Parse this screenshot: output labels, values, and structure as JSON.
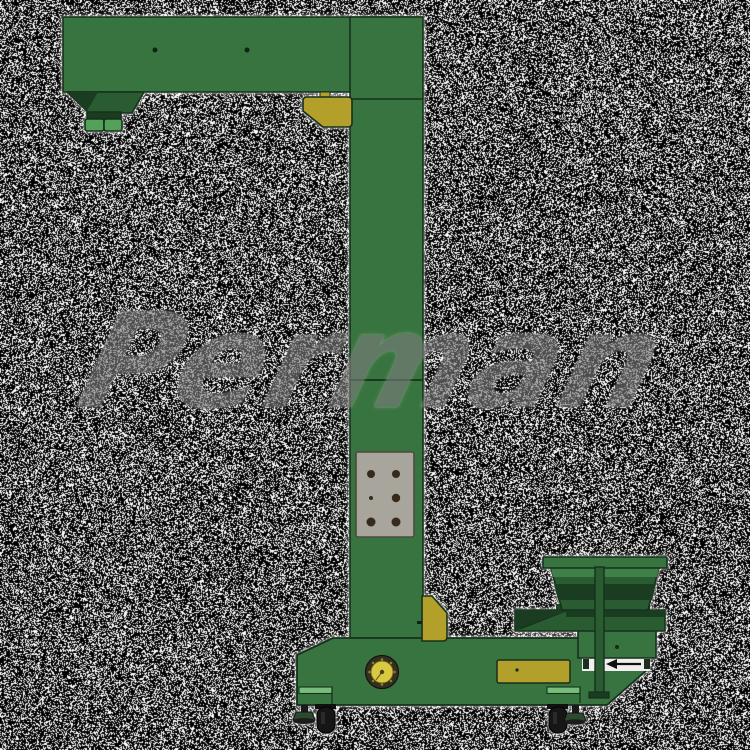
{
  "watermark": {
    "text": "Perman"
  },
  "background": {
    "style": "speckle-noise",
    "base_color": "#000000",
    "dot_color": "#ffffff",
    "white_ratio": 0.35
  },
  "machine": {
    "label": "z-type-bucket-elevator-with-vibratory-feeder",
    "colors": {
      "body_green": "#38743f",
      "body_green_dark": "#2a5c32",
      "shadow_green": "#1a3d22",
      "band_green": "#3f8049",
      "light_green": "#79bd7a",
      "outlet_green": "#54a15a",
      "accent_yellow": "#b2a02b",
      "pulley_yellow": "#d8c93f",
      "pulley_ring": "#35301d",
      "panel_gray": "#a8a59c",
      "hole_brown": "#352a1b",
      "outline": "#16301c",
      "wheel_black": "#161616",
      "foot_green": "#2c4a2e",
      "white_band": "#efefef",
      "arrow_black": "#111111",
      "watermark_gray": "#7d7d7d"
    }
  }
}
